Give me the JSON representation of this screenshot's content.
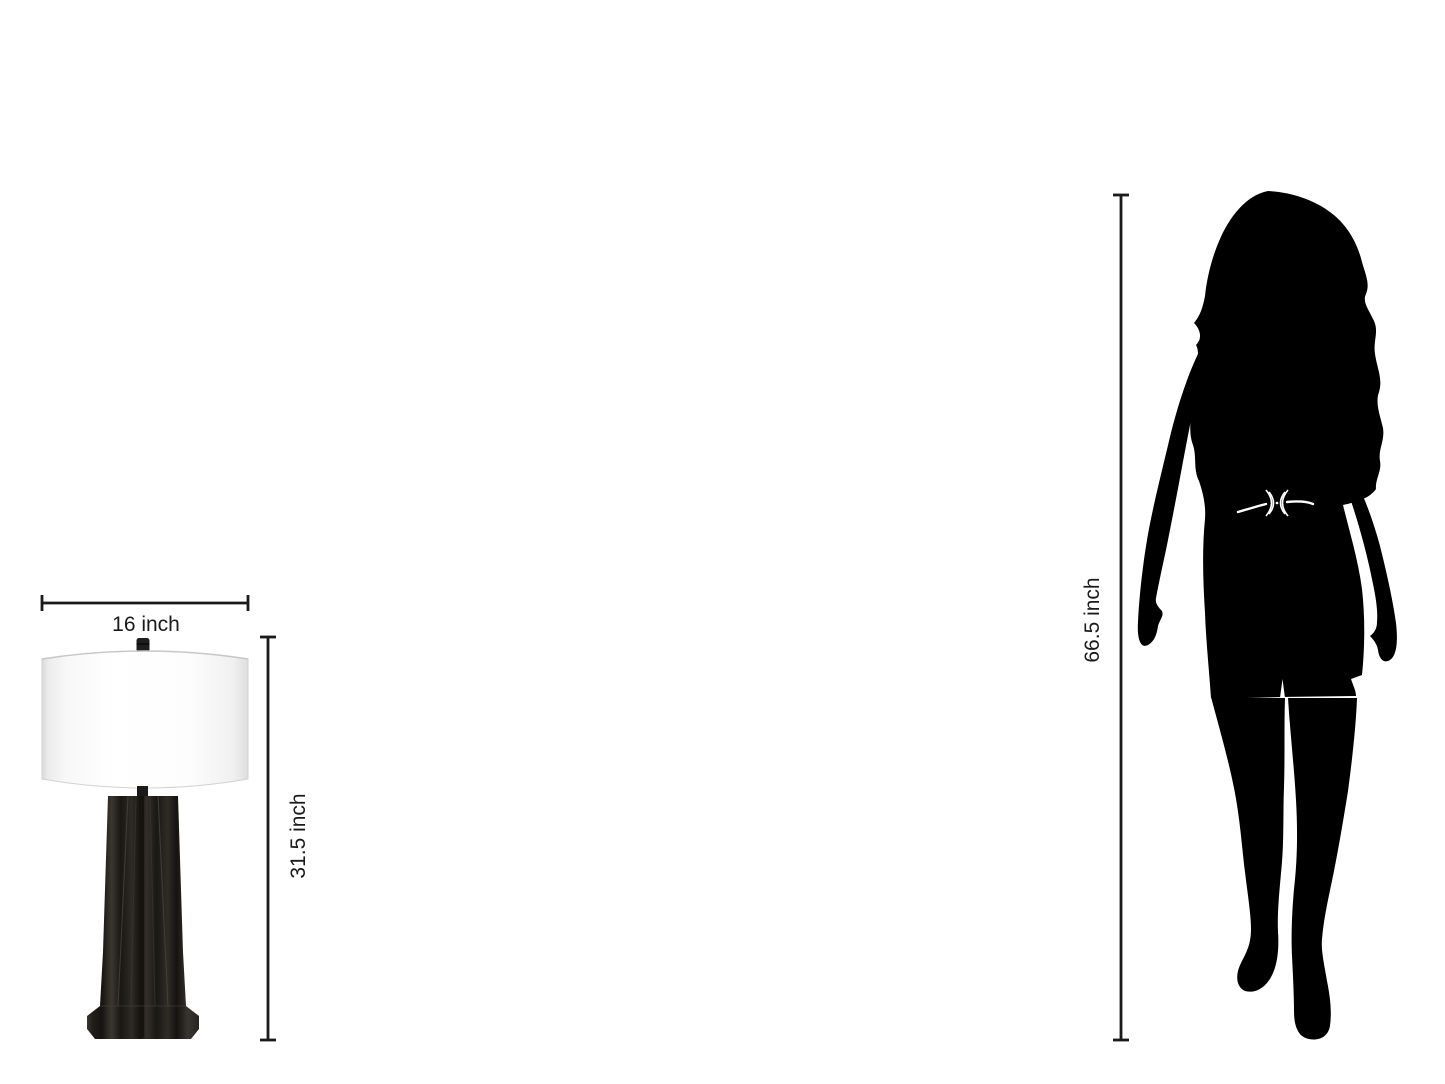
{
  "page": {
    "background_color": "#ffffff"
  },
  "lamp": {
    "item": "table-lamp",
    "width_annotation": "16 inch",
    "height_annotation": "31.5 inch",
    "shade_color": "#fdfdfd",
    "shade_edge_color": "#dcdcdc",
    "base_color": "#26231f"
  },
  "person": {
    "item": "woman-silhouette",
    "height_annotation": "66.5 inch",
    "silhouette_color": "#000000",
    "belt_color": "#ffffff"
  },
  "annotation_style": {
    "line_color": "#1a1a1a"
  }
}
